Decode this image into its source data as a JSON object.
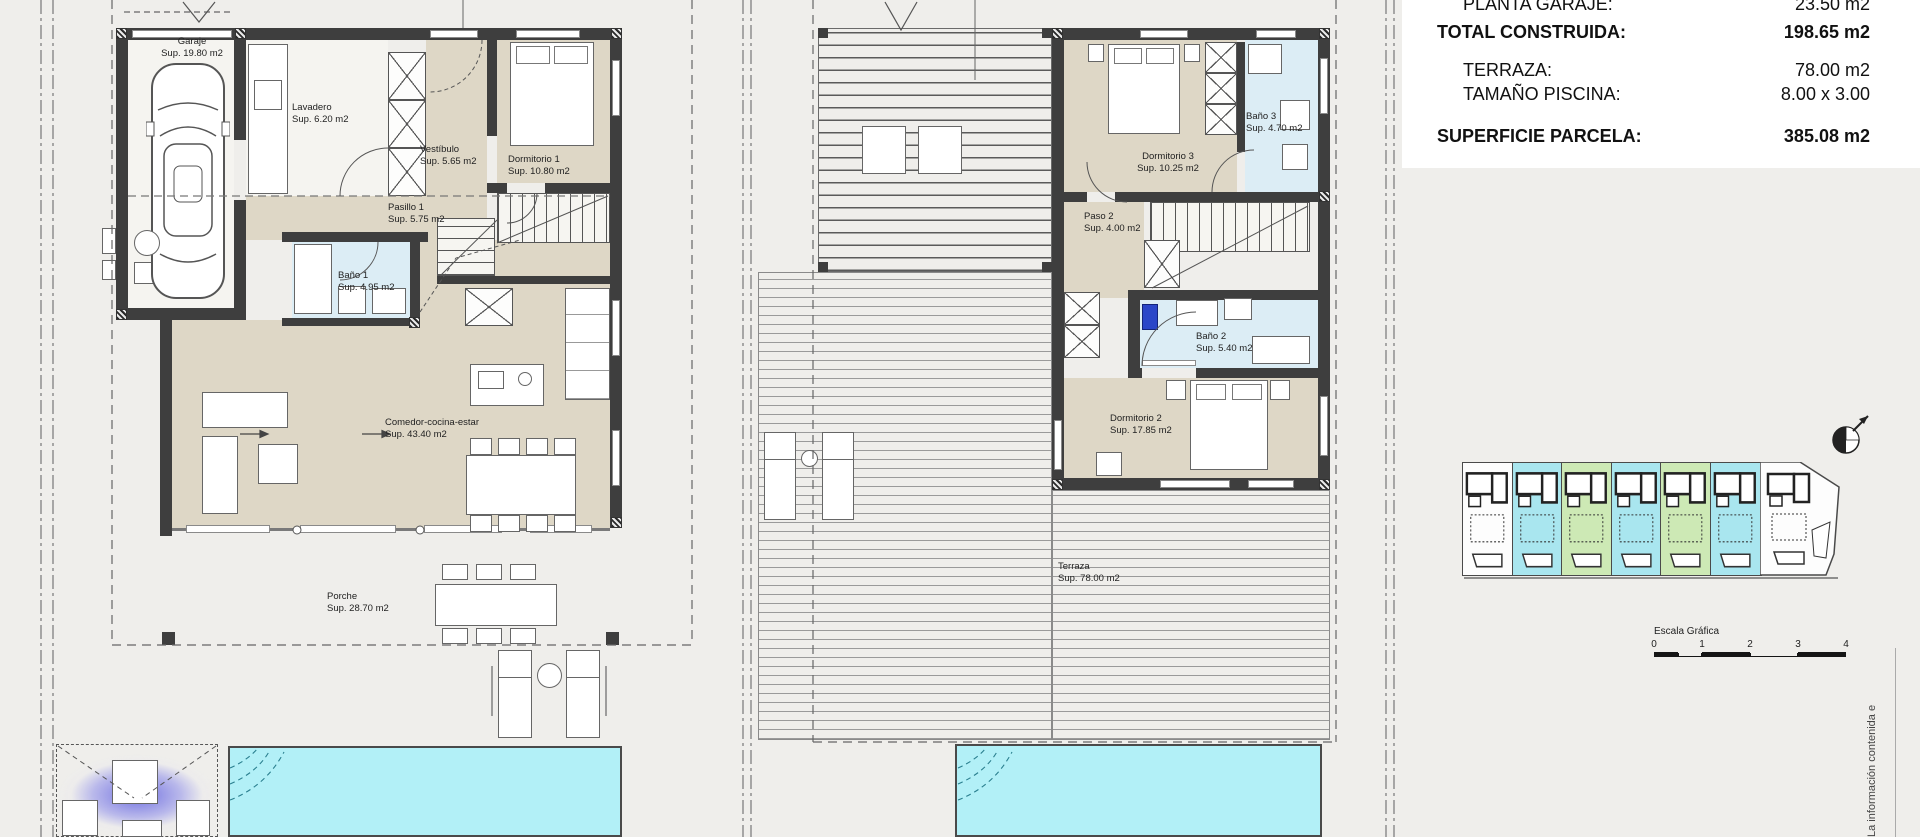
{
  "colors": {
    "background": "#efeeeb",
    "panel_white": "#ffffff",
    "wall": "#3e3e3e",
    "floor_beige": "#ded7c6",
    "floor_light": "#f5f4f0",
    "bath_blue": "#dcedf5",
    "pool_cyan": "#b2f0f7",
    "site_cyan": "#a9e6ef",
    "site_green": "#cde9b5",
    "accent_purple": "#7a7ae0",
    "deck_line": "#9a9a9a"
  },
  "summary_table": {
    "rows": [
      {
        "label": "PLANTA GARAJE:",
        "value": "23.50 m2"
      },
      {
        "label": "TOTAL CONSTRUIDA:",
        "value": "198.65 m2"
      },
      {
        "label": "TERRAZA:",
        "value": "78.00 m2"
      },
      {
        "label": "TAMAÑO PISCINA:",
        "value": "8.00 x 3.00"
      },
      {
        "label": "SUPERFICIE PARCELA:",
        "value": "385.08 m2"
      }
    ]
  },
  "ground_floor": {
    "rooms": [
      {
        "name": "Garaje",
        "sup": "Sup. 19.80 m2"
      },
      {
        "name": "Lavadero",
        "sup": "Sup. 6.20 m2"
      },
      {
        "name": "Vestíbulo",
        "sup": "Sup. 5.65 m2"
      },
      {
        "name": "Dormitorio 1",
        "sup": "Sup. 10.80 m2"
      },
      {
        "name": "Pasillo 1",
        "sup": "Sup. 5.75 m2"
      },
      {
        "name": "Baño 1",
        "sup": "Sup. 4.95 m2"
      },
      {
        "name": "Comedor-cocina-estar",
        "sup": "Sup. 43.40 m2"
      },
      {
        "name": "Porche",
        "sup": "Sup. 28.70 m2"
      }
    ]
  },
  "first_floor": {
    "rooms": [
      {
        "name": "Dormitorio 3",
        "sup": "Sup. 10.25 m2"
      },
      {
        "name": "Baño 3",
        "sup": "Sup. 4.70 m2"
      },
      {
        "name": "Paso 2",
        "sup": "Sup. 4.00 m2"
      },
      {
        "name": "Baño 2",
        "sup": "Sup. 5.40 m2"
      },
      {
        "name": "Dormitorio 2",
        "sup": "Sup. 17.85 m2"
      },
      {
        "name": "Terraza",
        "sup": "Sup. 78.00 m2"
      }
    ]
  },
  "site_plan": {
    "units": [
      "neutral",
      "cyan",
      "green",
      "cyan",
      "green",
      "cyan",
      "neutral"
    ]
  },
  "scale_bar": {
    "title": "Escala Gráfica",
    "ticks": [
      "0",
      "1",
      "2",
      "3",
      "4"
    ]
  },
  "disclaimer": "La información contenida e"
}
